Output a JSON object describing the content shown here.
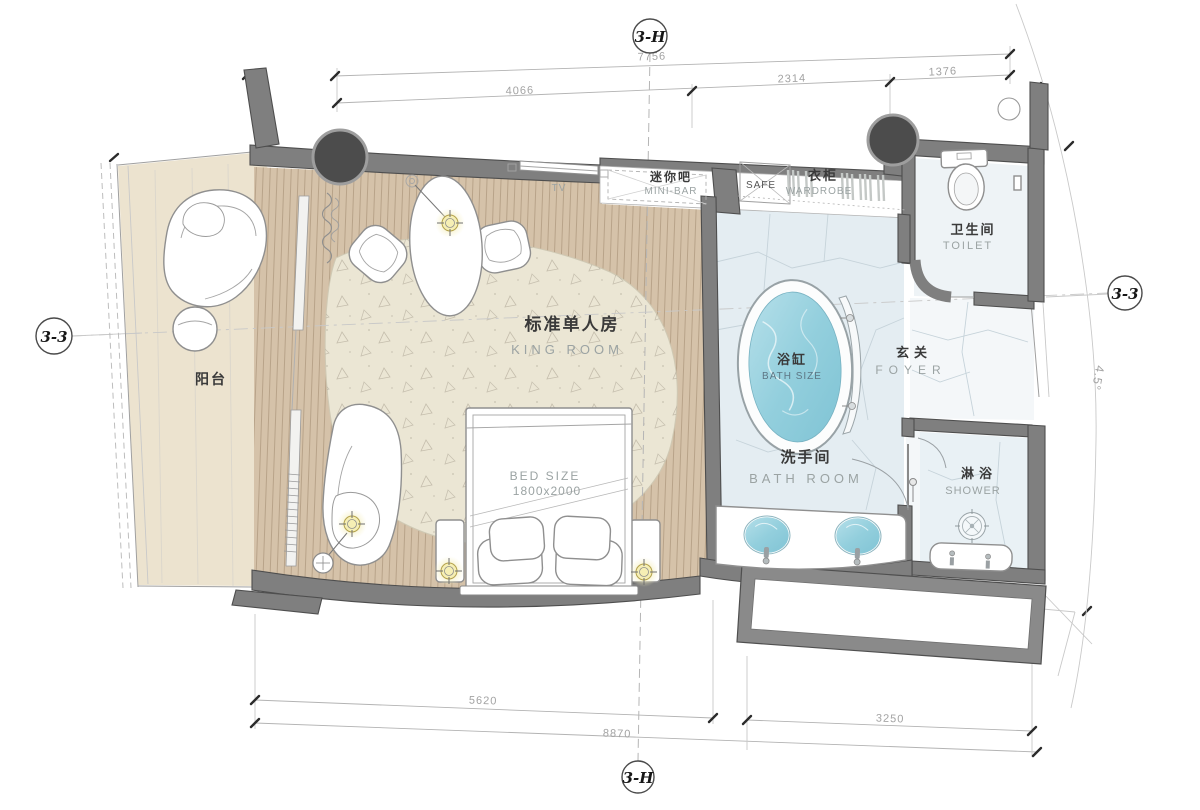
{
  "title": "King room floor plan",
  "markers": {
    "top": "3-H",
    "bottom": "3-H",
    "left": "3-3",
    "right": "3-3",
    "angle": "4.5°"
  },
  "dims_top": {
    "overall": "7756",
    "left": "4066",
    "middle": "2314",
    "right": "1376"
  },
  "dims_bottom": {
    "left": "5620",
    "right": "3250",
    "overall": "8870"
  },
  "rooms": {
    "balcony_zh": "阳台",
    "king_zh": "标准单人房",
    "king_en": "KING ROOM",
    "bath_zh": "洗手间",
    "bath_en": "BATH ROOM",
    "toilet_zh": "卫生间",
    "toilet_en": "TOILET",
    "shower_zh": "淋浴",
    "shower_en": "SHOWER",
    "foyer_zh": "玄关",
    "foyer_en": "FOYER"
  },
  "fixtures": {
    "minibar_zh": "迷你吧",
    "minibar_en": "MINI-BAR",
    "safe": "SAFE",
    "wardrobe_zh": "衣柜",
    "wardrobe_en": "WARDROBE",
    "tub_zh": "浴缸",
    "tub_en": "BATH SIZE",
    "bed_size_label": "BED SIZE",
    "bed_size_value": "1800x2000",
    "tv": "TV"
  },
  "colors": {
    "wall": "#7f7f7f",
    "wall-dark": "#4e4e4e",
    "wood": "#d5c2a9",
    "balcony": "#ece3cf",
    "rug": "#ebe6d4",
    "stone": "#e4edf2",
    "foyer-floor": "#f4f7f9",
    "toilet-floor": "#eef3f6",
    "shower-floor": "#e9f1f5",
    "water": "#8fcbdb",
    "glow": "#f1e79d",
    "column": "#4c4c4c"
  }
}
